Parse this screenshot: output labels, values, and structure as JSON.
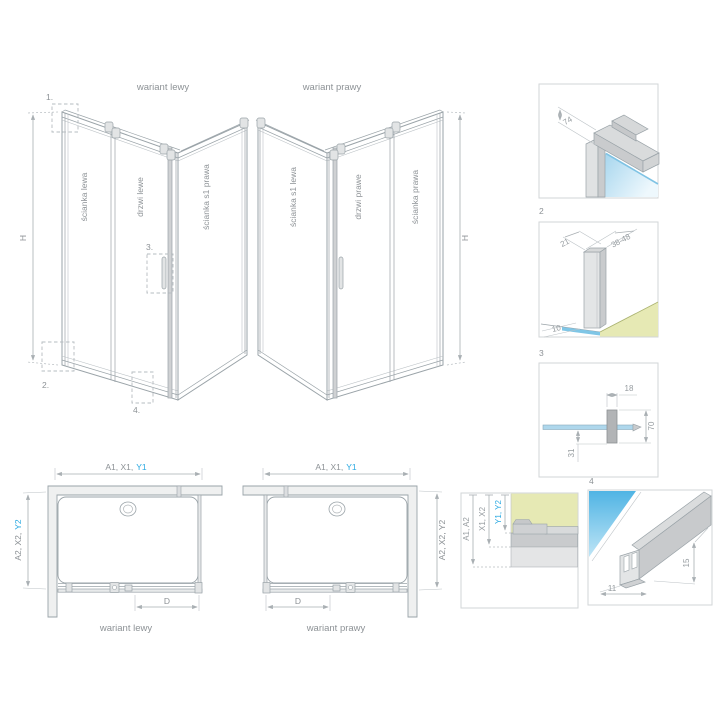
{
  "colors": {
    "accent_blue": "#2aa9e2",
    "wall_yellow": "#e6e9b4",
    "glass_blue": "#54b6e5",
    "line_gray": "#9aa3a8",
    "text_gray": "#8d9296"
  },
  "iso_left": {
    "title": "wariant lewy",
    "panel_left": "ścianka lewa",
    "panel_door": "drzwi lewe",
    "panel_right": "ścianka s1 prawa",
    "height_label": "H",
    "marker_1": "1.",
    "marker_2": "2.",
    "marker_3": "3.",
    "marker_4": "4."
  },
  "iso_right": {
    "title": "wariant prawy",
    "panel_left": "ścianka s1 lewa",
    "panel_door": "drzwi prawe",
    "panel_right": "ścianka prawa",
    "height_label": "H"
  },
  "detail_1": {
    "dim_74": "74"
  },
  "detail_2": {
    "number": "2",
    "dim_21": "21",
    "dim_38_48": "38-48",
    "dim_10": "10"
  },
  "detail_3": {
    "number": "3",
    "dim_18": "18",
    "dim_70": "70",
    "dim_31": "31"
  },
  "detail_4": {
    "number": "4",
    "dim_11": "11",
    "dim_15": "15"
  },
  "section_box": {
    "dim_a": "A1, A2",
    "dim_x": "X1, X2",
    "dim_y": "Y1, Y2"
  },
  "plan_left": {
    "dim_top_prefix": "A1, X1,",
    "dim_top_blue": "Y1",
    "dim_side_prefix": "A2, X2,",
    "dim_side_blue": "Y2",
    "door_width": "D",
    "caption": "wariant lewy"
  },
  "plan_right": {
    "dim_top_prefix": "A1, X1,",
    "dim_top_blue": "Y1",
    "dim_side": "A2, X2, Y2",
    "door_width": "D",
    "caption": "wariant prawy"
  }
}
